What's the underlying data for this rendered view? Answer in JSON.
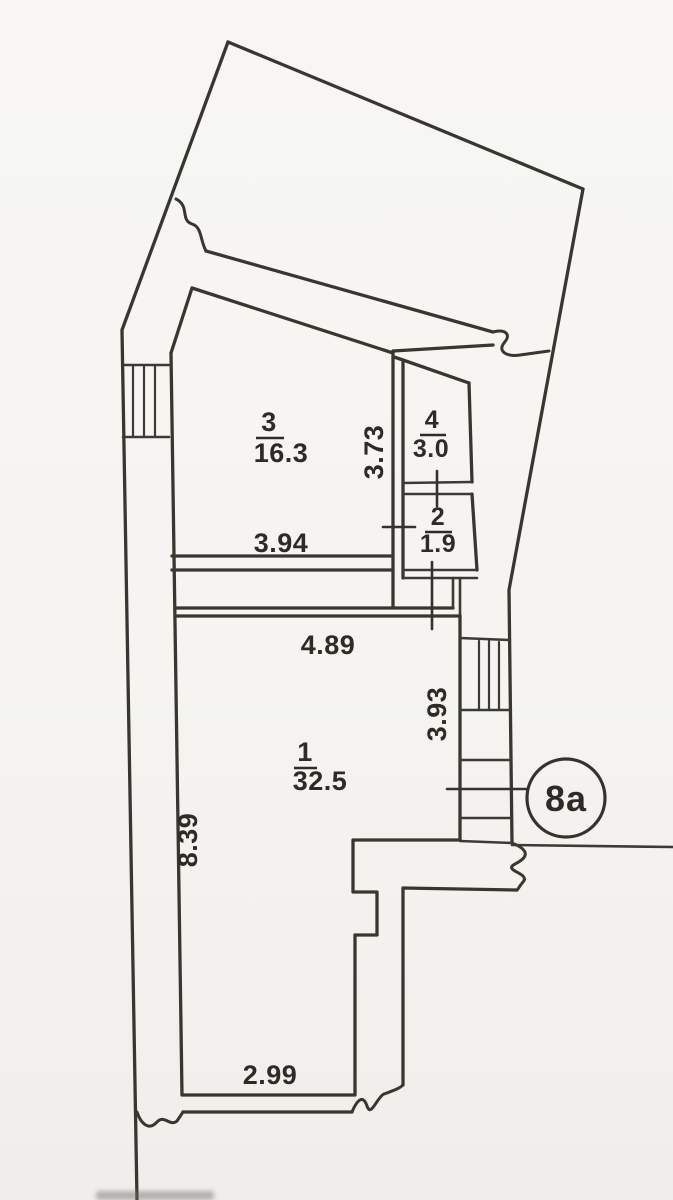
{
  "document": {
    "kind": "scanned floor plan",
    "paper_color": "#f5f4f1",
    "ink_color": "#38362f"
  },
  "plan": {
    "unit_badge": {
      "label": "8a"
    },
    "rooms": [
      {
        "number": "3",
        "area": "16.3"
      },
      {
        "number": "4",
        "area": "3.0"
      },
      {
        "number": "2",
        "area": "1.9"
      },
      {
        "number": "1",
        "area": "32.5"
      }
    ],
    "dimensions": [
      {
        "value": "3.94",
        "orientation": "horizontal",
        "location": "room-3-bottom"
      },
      {
        "value": "3.73",
        "orientation": "vertical",
        "location": "room-3-right"
      },
      {
        "value": "4.89",
        "orientation": "horizontal",
        "location": "room-1-top"
      },
      {
        "value": "3.93",
        "orientation": "vertical",
        "location": "room-1-right"
      },
      {
        "value": "8.39",
        "orientation": "vertical",
        "location": "room-1-left"
      },
      {
        "value": "2.99",
        "orientation": "horizontal",
        "location": "room-1-bottom"
      }
    ]
  }
}
